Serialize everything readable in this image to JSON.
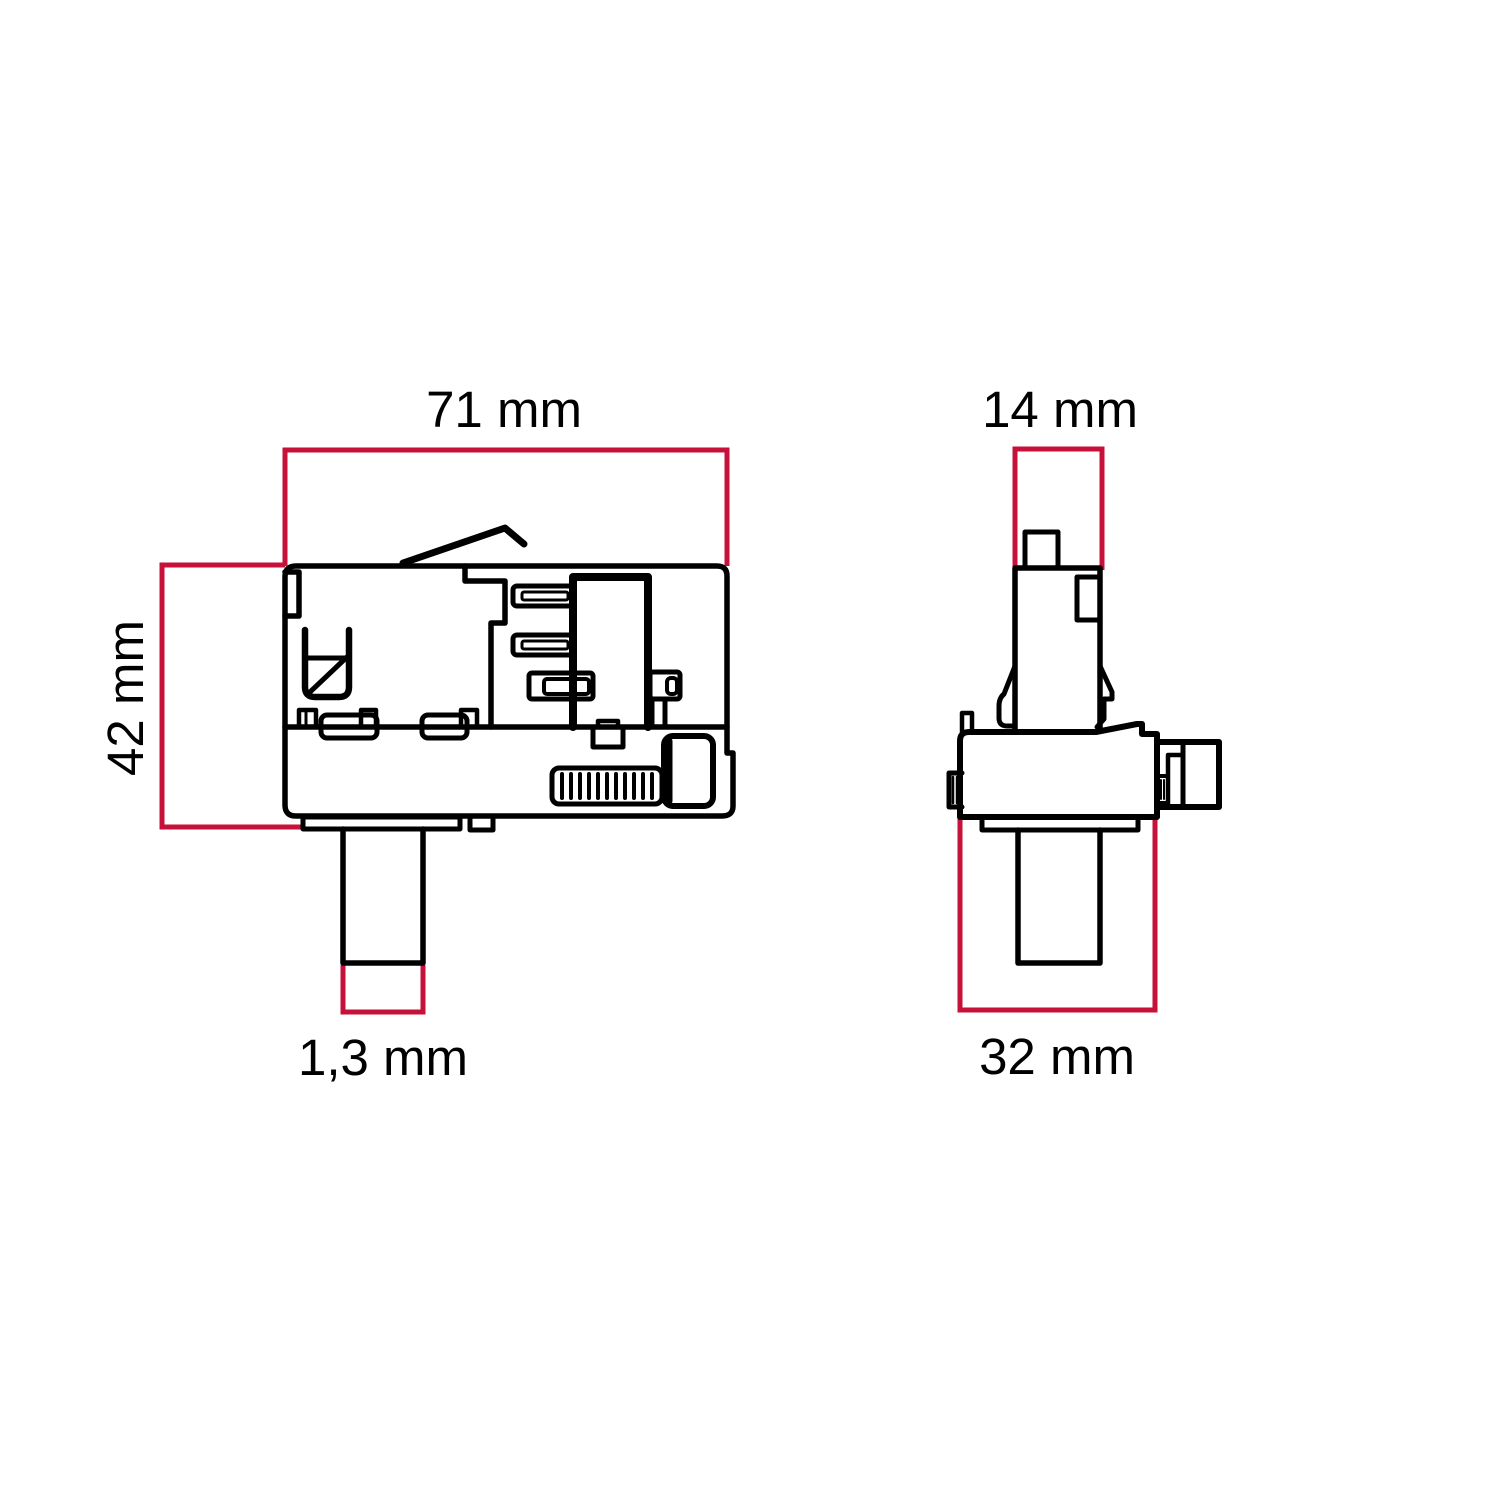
{
  "page": {
    "description": "Technical dimension drawing of a track lighting adapter, side view and front view",
    "background": "#ffffff"
  },
  "colors": {
    "drawing_line": "#000000",
    "dimension_line": "#c6113b",
    "label_text": "#000000"
  },
  "views": {
    "side": {
      "name": "side-view",
      "dim_width": "71 mm",
      "dim_height": "42 mm",
      "dim_stem": "1,3 mm"
    },
    "front": {
      "name": "front-view",
      "dim_top": "14 mm",
      "dim_width": "32 mm"
    }
  }
}
